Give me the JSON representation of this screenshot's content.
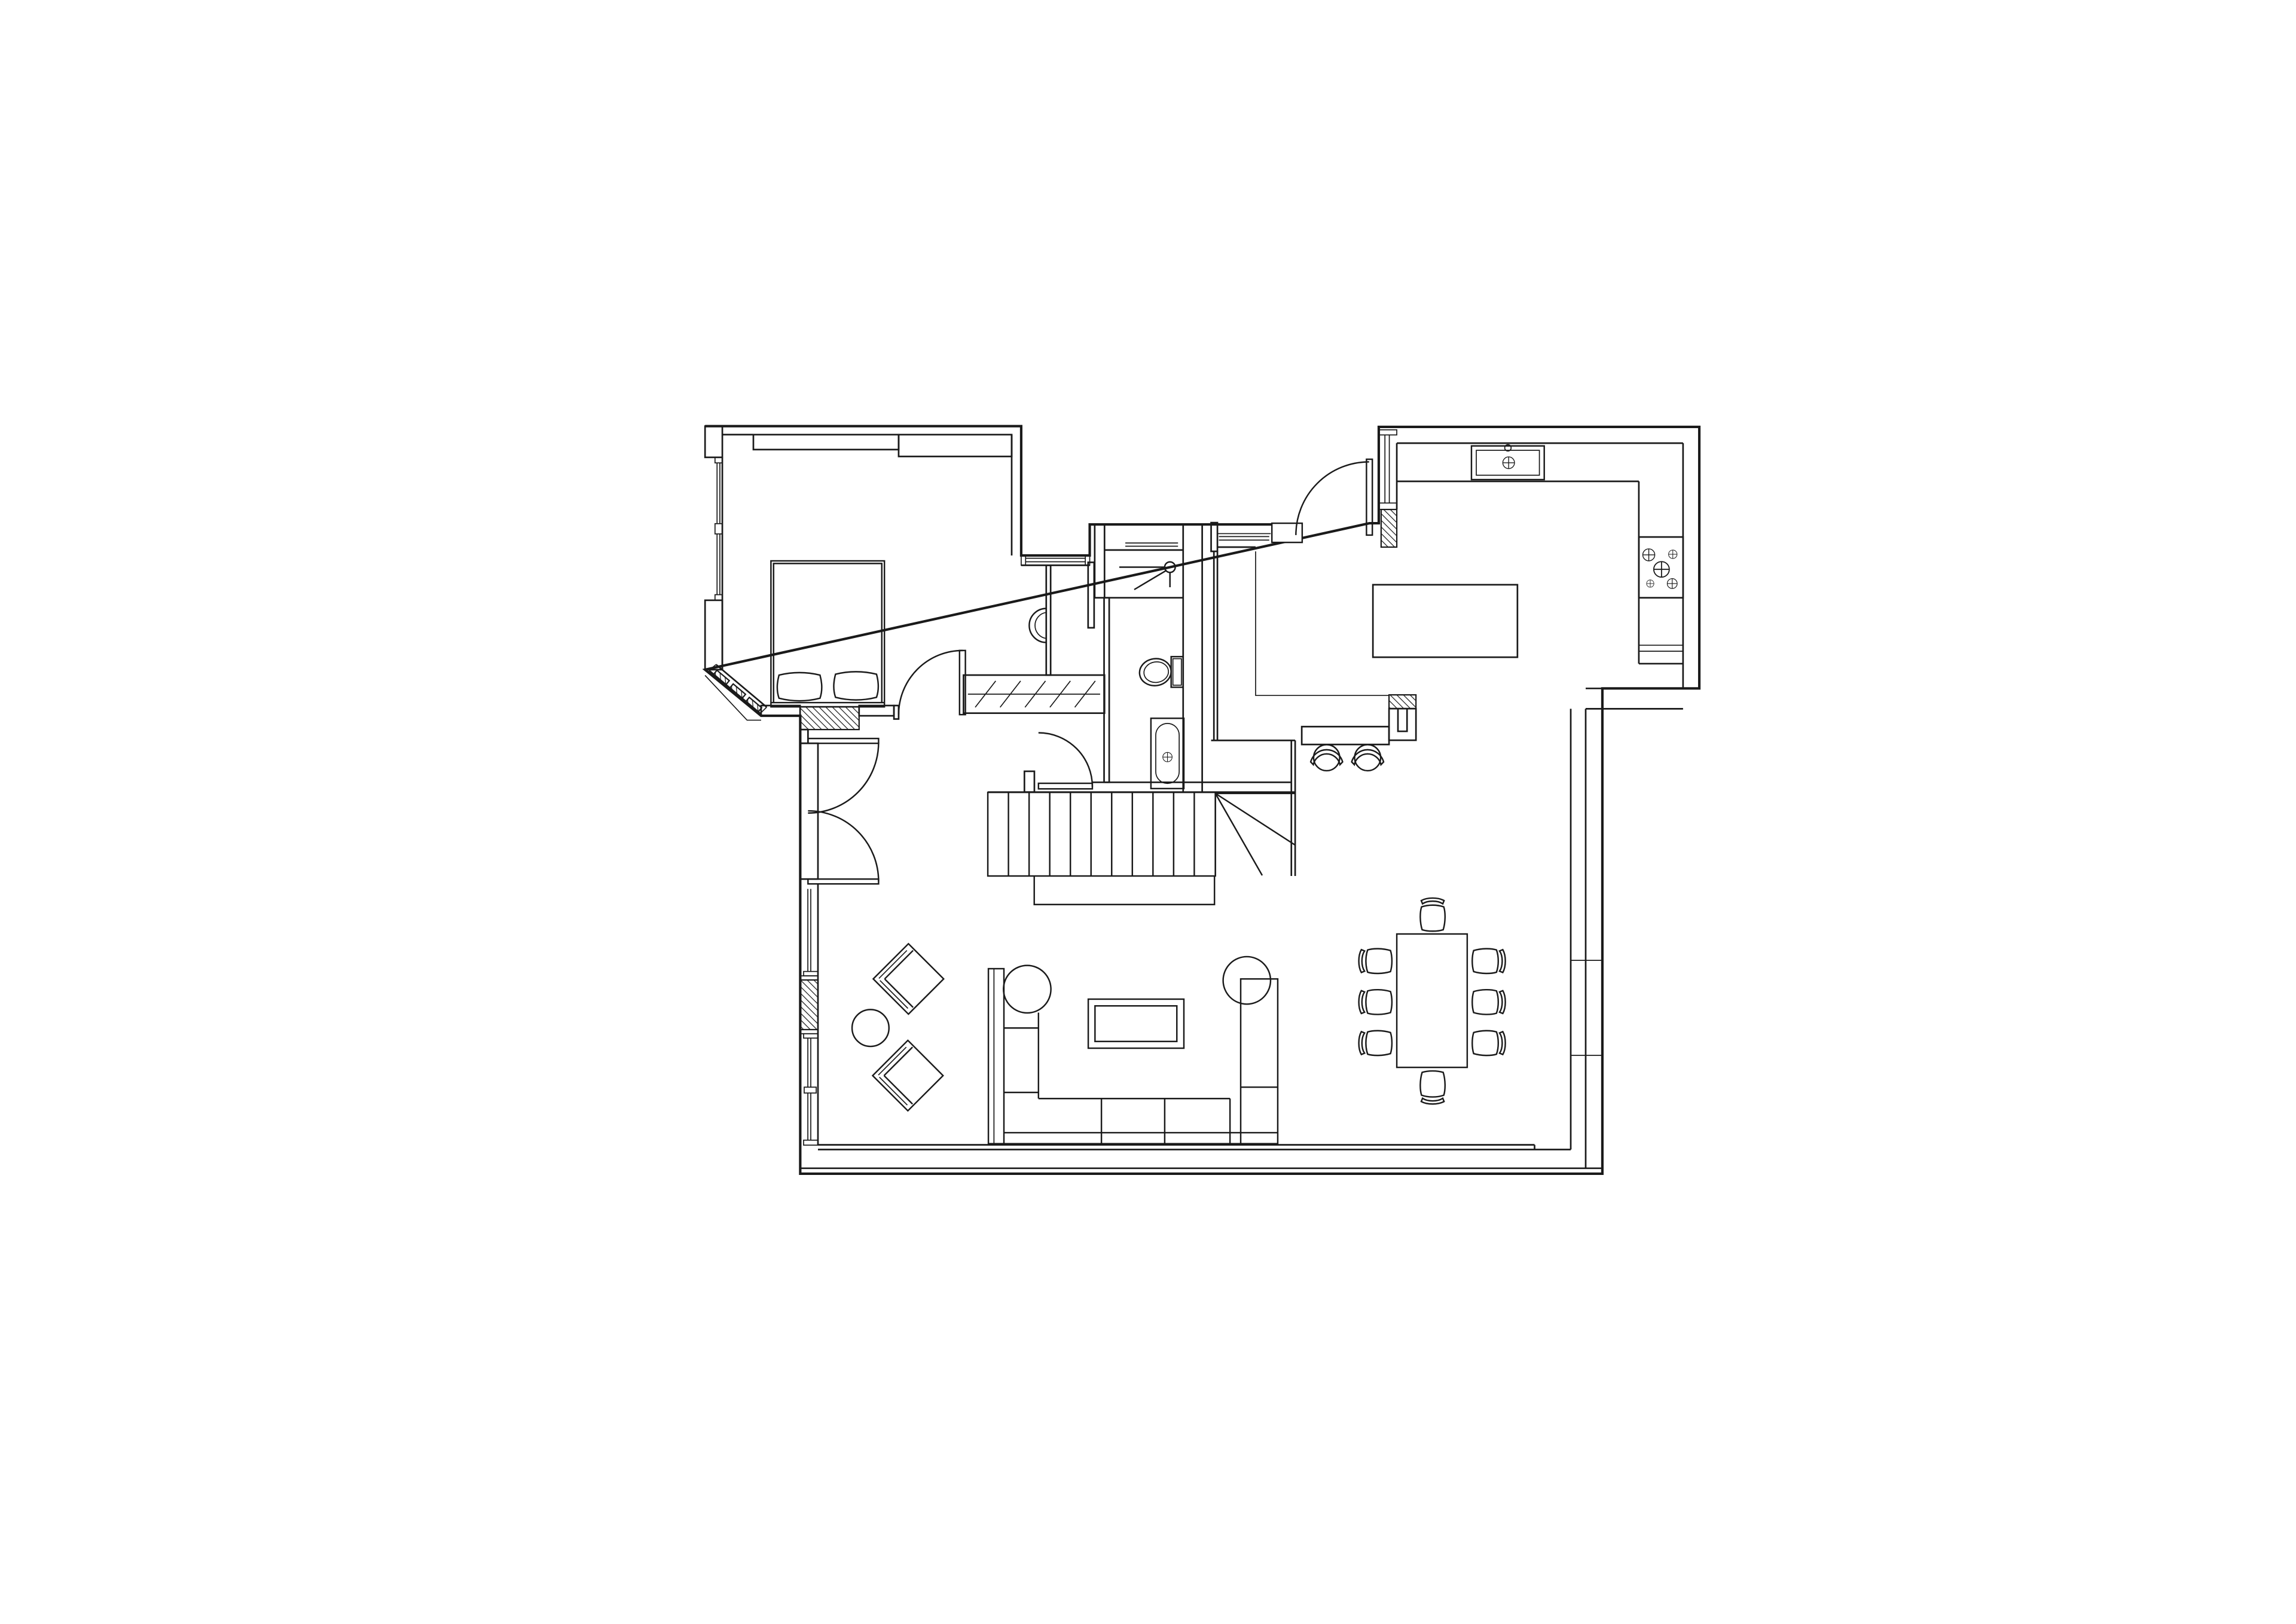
{
  "app": {
    "type": "architectural-floor-plan-drawing",
    "background_color": "#ffffff",
    "line_color": "#1a1a1a",
    "visible_text": []
  },
  "floor_plan": {
    "rooms": [
      {
        "name": "bedroom",
        "position": "top-left",
        "features": [
          "double-bed-with-two-pillows",
          "bay-corner-window",
          "left-wall-window",
          "radiator-recess",
          "built-in-top-wall-band"
        ]
      },
      {
        "name": "dressing-hall",
        "position": "center-top",
        "features": [
          "wall-hung-washbasin",
          "wardrobe-with-diagonal-hatch",
          "north-window"
        ]
      },
      {
        "name": "bathroom",
        "position": "center",
        "features": [
          "shower-with-head-symbol",
          "toilet-with-cistern",
          "bathtub-with-faucet-cross"
        ]
      },
      {
        "name": "entry-lobby",
        "position": "left-center",
        "features": [
          "two-opposed-swing-doors"
        ]
      },
      {
        "name": "kitchen",
        "position": "top-right",
        "features": [
          "counter-sink",
          "five-burner-cooktop",
          "island",
          "breakfast-bar",
          "two-bar-stools",
          "west-window",
          "entry-door"
        ]
      },
      {
        "name": "living-room",
        "position": "bottom-left",
        "features": [
          "u-shaped-sectional-sofa",
          "coffee-table",
          "two-rotated-armchairs",
          "round-side-table",
          "window-wall-with-radiator"
        ]
      },
      {
        "name": "dining-area",
        "position": "bottom-right",
        "features": [
          "rectangular-table",
          "eight-chairs"
        ]
      },
      {
        "name": "staircase",
        "position": "center-bottom",
        "features": [
          "straight-flight",
          "winder-turn"
        ]
      }
    ],
    "furniture_counts": {
      "bar_stools": 2,
      "dining_chairs": 8,
      "armchairs": 2,
      "sofa_sections": 6,
      "radiators": 2,
      "wall_piers_hatched": 2
    },
    "doors": [
      "bedroom-door",
      "lobby-north-door",
      "lobby-south-door",
      "hall-door",
      "kitchen-door"
    ],
    "windows": [
      "bedroom-west-window",
      "bay-corner-window",
      "dressing-north-window",
      "shower-north-window",
      "corridor-north-window",
      "kitchen-west-window",
      "living-west-windows",
      "dining-east-wall-panels"
    ]
  }
}
